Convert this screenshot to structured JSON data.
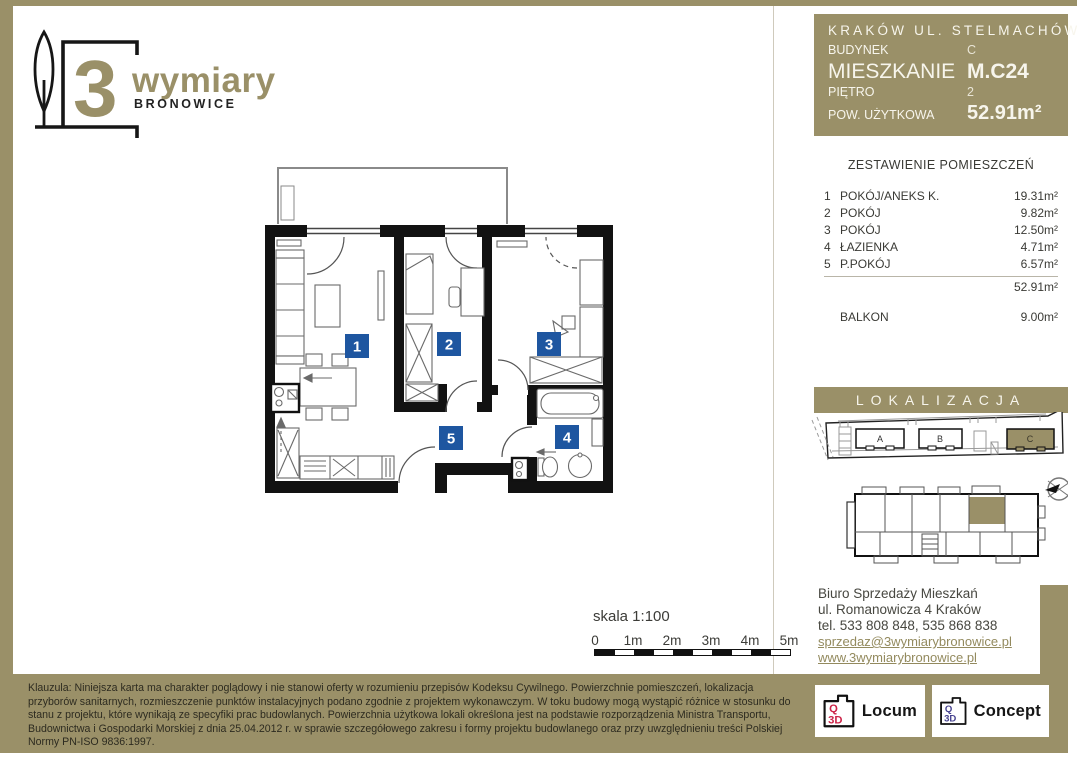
{
  "colors": {
    "olive": "#9a9068",
    "badge_blue": "#1e56a0",
    "locum_red": "#cc2347",
    "concept_indigo": "#45418f"
  },
  "brand": {
    "digit": "3",
    "name": "wymiary",
    "sub": "BRONOWICE"
  },
  "header": {
    "title": "KRAKÓW UL. STELMACHÓW",
    "building_label": "BUDYNEK",
    "building_value": "C",
    "apartment_label": "MIESZKANIE",
    "apartment_value": "M.C24",
    "floor_label": "PIĘTRO",
    "floor_value": "2",
    "area_label": "POW. UŻYTKOWA",
    "area_value": "52.91m²"
  },
  "rooms": {
    "title": "ZESTAWIENIE POMIESZCZEŃ",
    "rows": [
      {
        "no": "1",
        "name": "POKÓJ/ANEKS K.",
        "area": "19.31m²"
      },
      {
        "no": "2",
        "name": "POKÓJ",
        "area": "9.82m²"
      },
      {
        "no": "3",
        "name": "POKÓJ",
        "area": "12.50m²"
      },
      {
        "no": "4",
        "name": "ŁAZIENKA",
        "area": "4.71m²"
      },
      {
        "no": "5",
        "name": "P.POKÓJ",
        "area": "6.57m²"
      }
    ],
    "total": "52.91m²",
    "balcony_label": "BALKON",
    "balcony_area": "9.00m²"
  },
  "plan": {
    "badges": [
      "1",
      "2",
      "3",
      "4",
      "5"
    ]
  },
  "scale": {
    "label": "skala 1:100",
    "ticks": [
      "0",
      "1m",
      "2m",
      "3m",
      "4m",
      "5m"
    ]
  },
  "localization": {
    "title": "LOKALIZACJA",
    "buildings": [
      "A",
      "B",
      "C"
    ]
  },
  "contact": {
    "line1": "Biuro Sprzedaży Mieszkań",
    "line2": "ul. Romanowicza 4 Kraków",
    "line3": "tel. 533 808 848, 535 868 838",
    "email": "sprzedaz@3wymiarybronowice.pl",
    "www": "www.3wymiarybronowice.pl"
  },
  "disclaimer": "Klauzula: Niniejsza karta ma charakter poglądowy i nie stanowi oferty w rozumieniu przepisów Kodeksu Cywilnego. Powierzchnie pomieszczeń, lokalizacja przyborów sanitarnych, rozmieszczenie punktów instalacyjnych podano zgodnie z projektem wykonawczym. W toku budowy mogą wystąpić różnice w stosunku do stanu z projektu, które wynikają ze specyfiki prac budowlanych. Powierzchnia użytkowa lokali określona jest na podstawie rozporządzenia Ministra Transportu, Budownictwa i Gospodarki Morskiej z dnia 25.04.2012 r. w sprawie szczegółowego zakresu i formy projektu budowlanego oraz przy uwzględnieniu treści Polskiej Normy PN-ISO 9836:1997.",
  "partners": [
    {
      "q": "Q",
      "d": "3D",
      "label": "Locum"
    },
    {
      "q": "Q",
      "d": "3D",
      "label": "Concept"
    }
  ]
}
